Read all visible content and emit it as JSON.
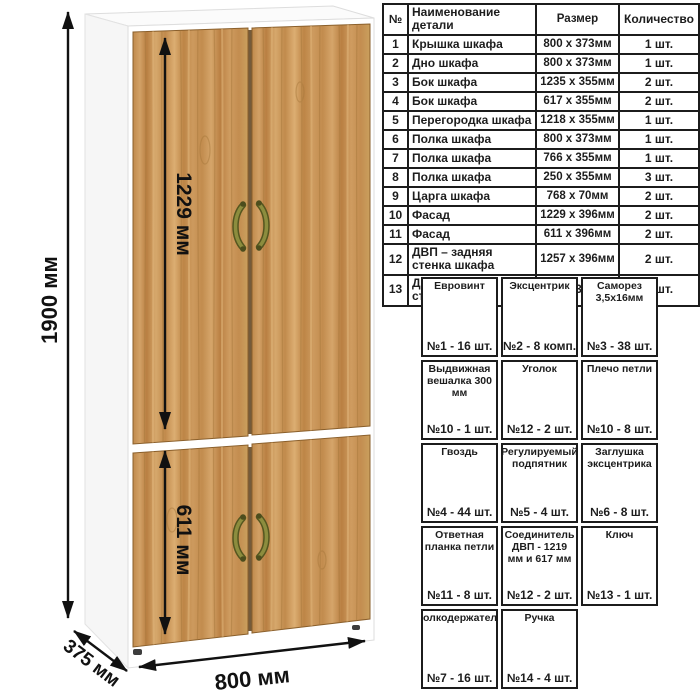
{
  "dimensions": {
    "height_total": "1900 мм",
    "upper_door_height": "1229 мм",
    "lower_door_height": "611 мм",
    "width": "800 мм",
    "depth": "375 мм"
  },
  "parts_table": {
    "headers": {
      "num": "№",
      "name": "Наименование детали",
      "size": "Размер",
      "qty": "Количество"
    },
    "rows": [
      {
        "num": "1",
        "name": "Крышка шкафа",
        "size": "800 x 373мм",
        "qty": "1 шт."
      },
      {
        "num": "2",
        "name": "Дно шкафа",
        "size": "800 x 373мм",
        "qty": "1 шт."
      },
      {
        "num": "3",
        "name": "Бок шкафа",
        "size": "1235 x 355мм",
        "qty": "2 шт."
      },
      {
        "num": "4",
        "name": "Бок шкафа",
        "size": "617 x 355мм",
        "qty": "2 шт."
      },
      {
        "num": "5",
        "name": "Перегородка шкафа",
        "size": "1218 x 355мм",
        "qty": "1 шт."
      },
      {
        "num": "6",
        "name": "Полка шкафа",
        "size": "800 x 373мм",
        "qty": "1 шт."
      },
      {
        "num": "7",
        "name": "Полка шкафа",
        "size": "766 x 355мм",
        "qty": "1 шт."
      },
      {
        "num": "8",
        "name": "Полка шкафа",
        "size": "250 x 355мм",
        "qty": "3 шт."
      },
      {
        "num": "9",
        "name": "Царга шкафа",
        "size": "768 x 70мм",
        "qty": "2 шт."
      },
      {
        "num": "10",
        "name": "Фасад",
        "size": "1229 x 396мм",
        "qty": "2 шт."
      },
      {
        "num": "11",
        "name": "Фасад",
        "size": "611 x 396мм",
        "qty": "2 шт."
      },
      {
        "num": "12",
        "name": "ДВП – задняя стенка шкафа",
        "size": "1257 x 396мм",
        "qty": "2 шт."
      },
      {
        "num": "13",
        "name": "ДВП – задняя стенка шкафа",
        "size": "639 x 396мм",
        "qty": "2 шт."
      }
    ]
  },
  "hardware": {
    "items": [
      {
        "name": "Евровинт",
        "icon": "euro-screw",
        "count": "№1 - 16 шт."
      },
      {
        "name": "Эксцентрик",
        "icon": "eccentric-cam",
        "count": "№2 - 8 комп."
      },
      {
        "name": "Саморез 3,5x16мм",
        "icon": "self-tapping-screw",
        "count": "№3 - 38 шт."
      },
      {
        "name": "Выдвижная вешалка 300 мм",
        "icon": "pull-out-hanger",
        "count": "№10 - 1 шт."
      },
      {
        "name": "Уголок",
        "icon": "corner-bracket",
        "count": "№12 - 2 шт."
      },
      {
        "name": "Плечо петли",
        "icon": "hinge-arm",
        "count": "№10 - 8 шт."
      },
      {
        "name": "Гвоздь",
        "icon": "nail",
        "count": "№4 - 44 шт."
      },
      {
        "name": "Регулируемый подпятник",
        "icon": "adjustable-foot",
        "count": "№5 - 4 шт."
      },
      {
        "name": "Заглушка эксцентрика",
        "icon": "cam-cover-cap",
        "count": "№6 - 8 шт."
      },
      {
        "name": "Ответная планка петли",
        "icon": "hinge-mounting-plate",
        "count": "№11 - 8 шт."
      },
      {
        "name": "Соединитель ДВП - 1219 мм и 617 мм",
        "icon": "hdf-connector",
        "count": "№12 - 2 шт."
      },
      {
        "name": "Ключ",
        "icon": "hex-key",
        "count": "№13 - 1 шт."
      },
      {
        "name": "Полкодержатель",
        "icon": "shelf-pin",
        "count": "№7 - 16 шт."
      },
      {
        "name": "Ручка",
        "icon": "handle",
        "count": "№14 - 4 шт."
      }
    ]
  },
  "colors": {
    "wood_mid": "#c79254",
    "wood_light": "#dcae72",
    "wood_dark": "#b07c3f",
    "carcass_white": "#ffffff",
    "handle_olive": "#6d6e2b",
    "table_border": "#1c1c1c"
  }
}
